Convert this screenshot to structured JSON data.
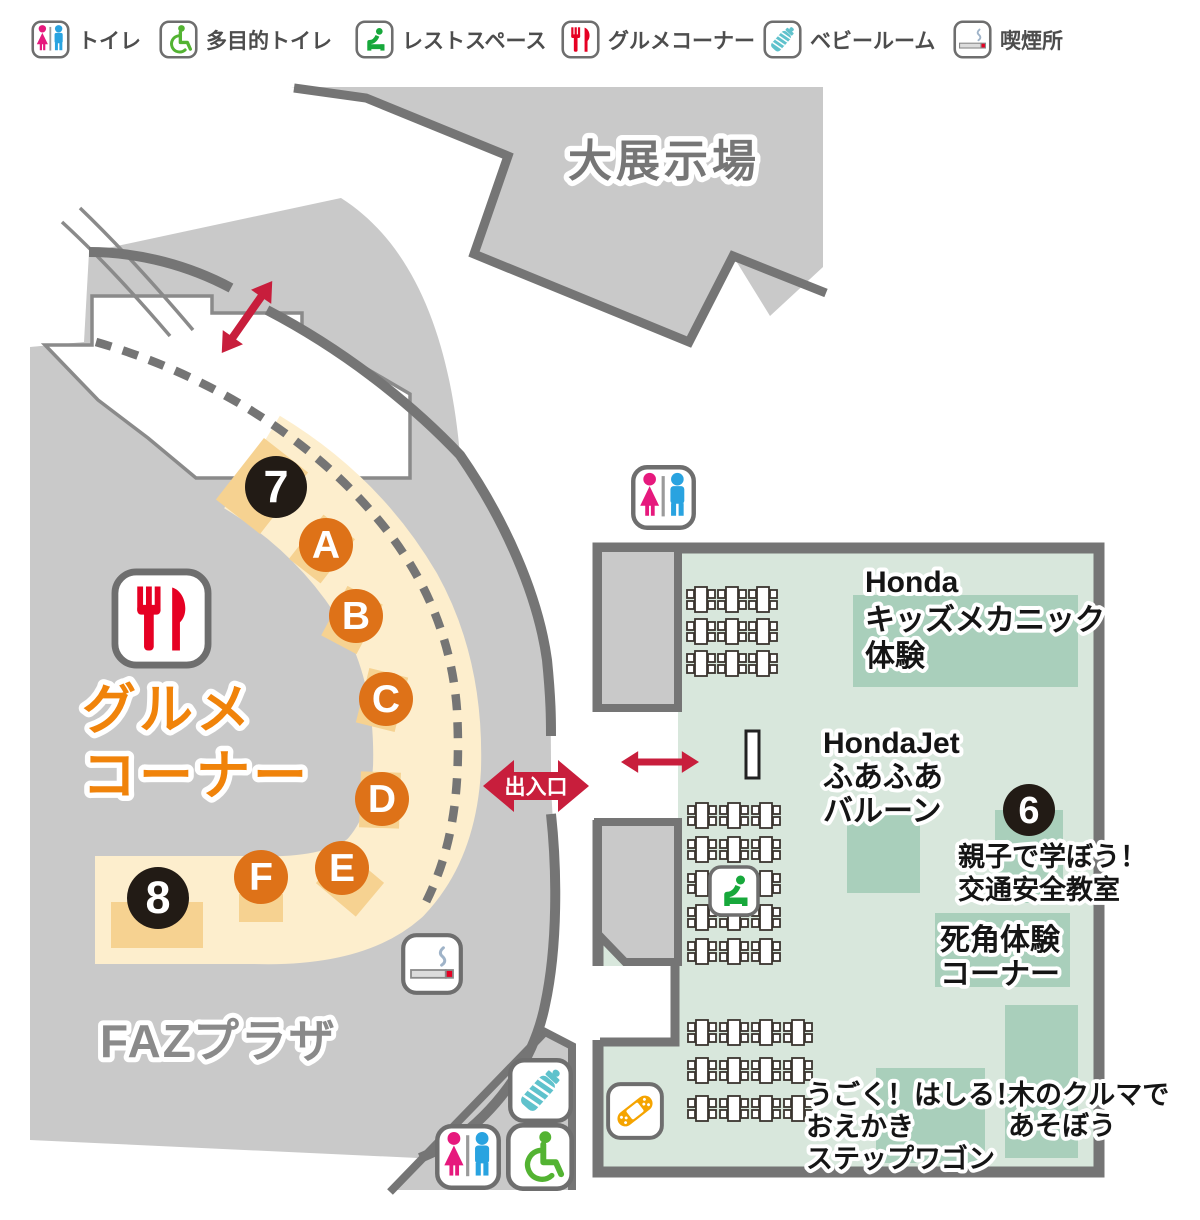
{
  "legend": {
    "items": [
      {
        "id": "toilet",
        "label": "トイレ"
      },
      {
        "id": "accessible-toilet",
        "label": "多目的トイレ"
      },
      {
        "id": "rest-space",
        "label": "レストスペース"
      },
      {
        "id": "gourmet-corner",
        "label": "グルメコーナー"
      },
      {
        "id": "baby-room",
        "label": "ベビールーム"
      },
      {
        "id": "smoking-area",
        "label": "喫煙所"
      }
    ]
  },
  "map": {
    "large_exhibition_hall": "大展示場",
    "faz_plaza": "FAZプラザ",
    "gourmet_corner": {
      "line1": "グルメ",
      "line2": "コーナー"
    },
    "entrance_label": "出入口",
    "booths": {
      "honda_kids": {
        "line1": "Honda",
        "line2": "キッズメカニック",
        "line3": "体験"
      },
      "hondajet": {
        "line1": "HondaJet",
        "line2": "ふあふあ",
        "line3": "バルーン"
      },
      "traffic_safety": {
        "number": "6",
        "line1": "親子で学ぼう！",
        "line2": "交通安全教室"
      },
      "blind_spot": {
        "line1": "死角体験",
        "line2": "コーナー"
      },
      "stepwgn": {
        "line1": "うごく！はしる！",
        "line2": "おえかき",
        "line3": "ステップワゴン"
      },
      "wooden_car": {
        "line1": "木のクルマで",
        "line2": "あそぼう"
      }
    },
    "stalls": [
      {
        "label": "7",
        "type": "number",
        "x": 276,
        "y": 487,
        "r": 31
      },
      {
        "label": "A",
        "type": "letter",
        "x": 326,
        "y": 545,
        "r": 27
      },
      {
        "label": "B",
        "type": "letter",
        "x": 356,
        "y": 616,
        "r": 27
      },
      {
        "label": "C",
        "type": "letter",
        "x": 386,
        "y": 699,
        "r": 27
      },
      {
        "label": "D",
        "type": "letter",
        "x": 382,
        "y": 799,
        "r": 27
      },
      {
        "label": "E",
        "type": "letter",
        "x": 342,
        "y": 868,
        "r": 27
      },
      {
        "label": "F",
        "type": "letter",
        "x": 261,
        "y": 877,
        "r": 27
      },
      {
        "label": "8",
        "type": "number",
        "x": 158,
        "y": 898,
        "r": 31
      }
    ],
    "tables": {
      "groups": [
        {
          "x": 687,
          "y": 587,
          "cols": 3,
          "rows": 3,
          "dx": 31,
          "dy": 32
        },
        {
          "x": 688,
          "y": 803,
          "cols": 3,
          "rows": 5,
          "dx": 32,
          "dy": 34
        },
        {
          "x": 688,
          "y": 1020,
          "cols": 4,
          "rows": 3,
          "dx": 32,
          "dy": 38
        }
      ]
    }
  },
  "colors": {
    "map_gray": "#c9c9c9",
    "wall": "#757575",
    "room_green": "#d8e7dc",
    "panel_green": "#a9cfbb",
    "cream": "#fdeecd",
    "stall_tan": "#f6d291",
    "number_circle": "#221b15",
    "letter_circle": "#de7218",
    "red": "#c81e3c",
    "gourmet_orange": "#f0830a"
  }
}
